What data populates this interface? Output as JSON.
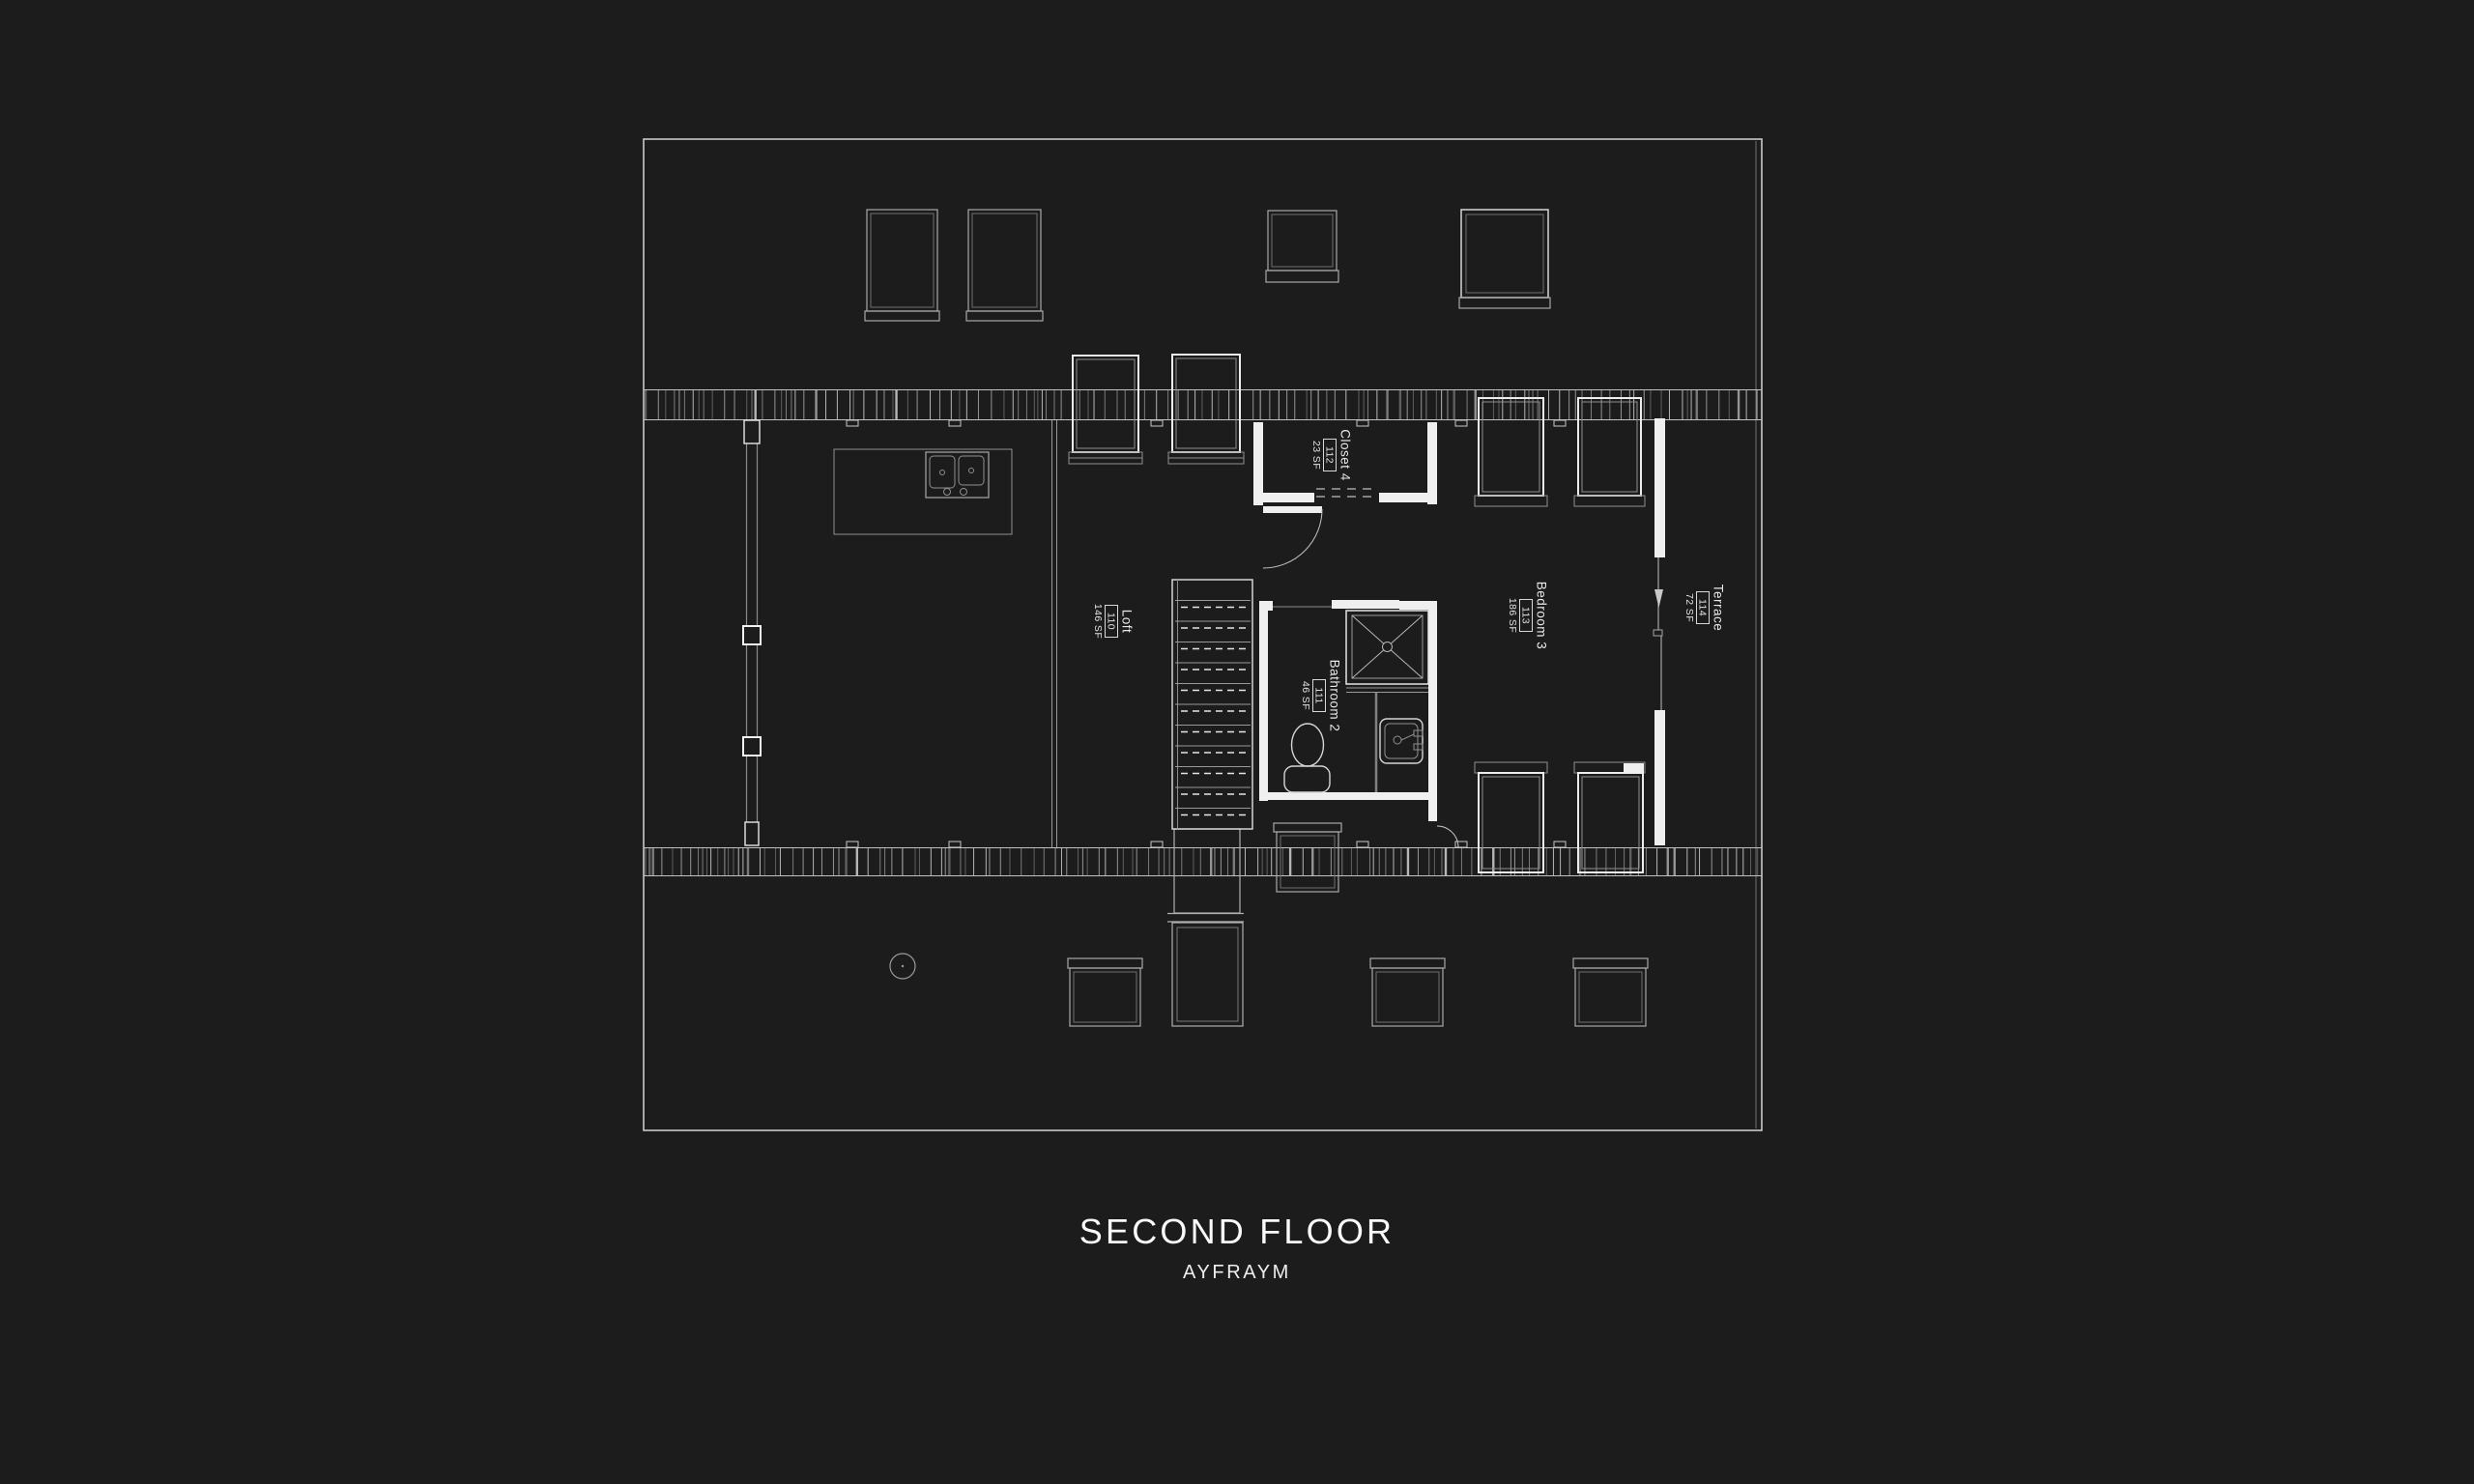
{
  "title": "SECOND FLOOR",
  "subtitle": "AYFRAYM",
  "rooms": {
    "loft": {
      "name": "Loft",
      "number": "110",
      "area": "146 SF"
    },
    "bathroom2": {
      "name": "Bathroom 2",
      "number": "111",
      "area": "46 SF"
    },
    "closet4": {
      "name": "Closet 4",
      "number": "112",
      "area": "23 SF"
    },
    "bedroom3": {
      "name": "Bedroom 3",
      "number": "113",
      "area": "186 SF"
    },
    "terrace": {
      "name": "Terrace",
      "number": "114",
      "area": "72 SF"
    }
  },
  "colors": {
    "background": "#1c1c1c",
    "wall": "#efefef",
    "bright_line": "#ececec",
    "medium_line": "#a8a8a8",
    "faint_line": "#6f6f6f",
    "text": "#fafafa"
  }
}
